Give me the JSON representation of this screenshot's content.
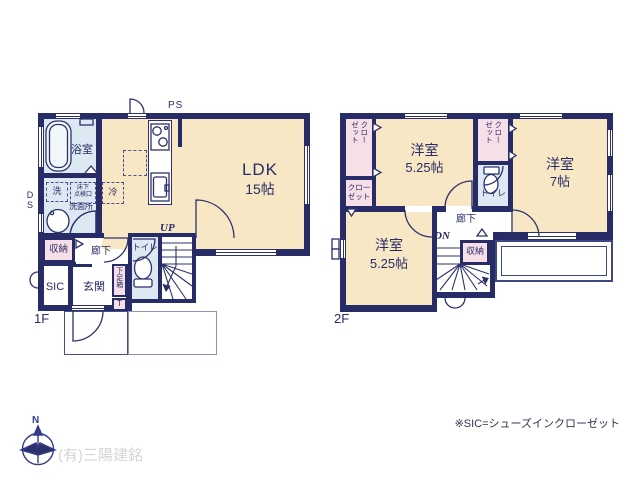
{
  "colors": {
    "wall_navy": "#272c66",
    "line_navy": "#2c316b",
    "room_beige": "#f8e7c5",
    "room_blue": "#dce8f2",
    "room_pink": "#f7dfe8",
    "outline_muted": "#8b92b8",
    "company_gray": "#d4d4d4"
  },
  "floor1": {
    "floor_label": "1F",
    "ps_label": "PS",
    "ds_label_1": "D",
    "ds_label_2": "S",
    "stairs_label": "UP",
    "rooms": {
      "ldk": {
        "name": "LDK",
        "size": "15帖"
      },
      "bath": {
        "name": "浴室"
      },
      "laundry": {
        "name": "洗"
      },
      "hatch": {
        "line1": "床下",
        "line2": "点検口"
      },
      "washroom": {
        "name": "洗面所"
      },
      "fridge": {
        "name": "冷"
      },
      "storage": {
        "name": "収納"
      },
      "hallway": {
        "name": "廊下"
      },
      "toilet": {
        "name": "トイレ"
      },
      "sic": {
        "name": "SIC"
      },
      "entrance": {
        "name": "玄関"
      },
      "shoebox": {
        "name": "下足箱",
        "tag": "T"
      }
    }
  },
  "floor2": {
    "floor_label": "2F",
    "stairs_label": "DN",
    "rooms": {
      "bedroom_top": {
        "name": "洋室",
        "size": "5.25帖"
      },
      "bedroom_right": {
        "name": "洋室",
        "size": "7帖"
      },
      "bedroom_bottom": {
        "name": "洋室",
        "size": "5.25帖"
      },
      "closet_top_left": {
        "col1": "クロー",
        "col2": "ゼット"
      },
      "closet_mid_left": {
        "line1": "クロー",
        "line2": "ゼット"
      },
      "closet_top_right": {
        "col1": "クロー",
        "col2": "ゼット"
      },
      "toilet": {
        "name": "トイレ"
      },
      "hallway": {
        "name": "廊下"
      },
      "storage": {
        "name": "収納"
      }
    }
  },
  "footer": {
    "compass_north": "N",
    "company": "(有)三陽建銘",
    "note": "※SIC=シューズインクローゼット"
  }
}
